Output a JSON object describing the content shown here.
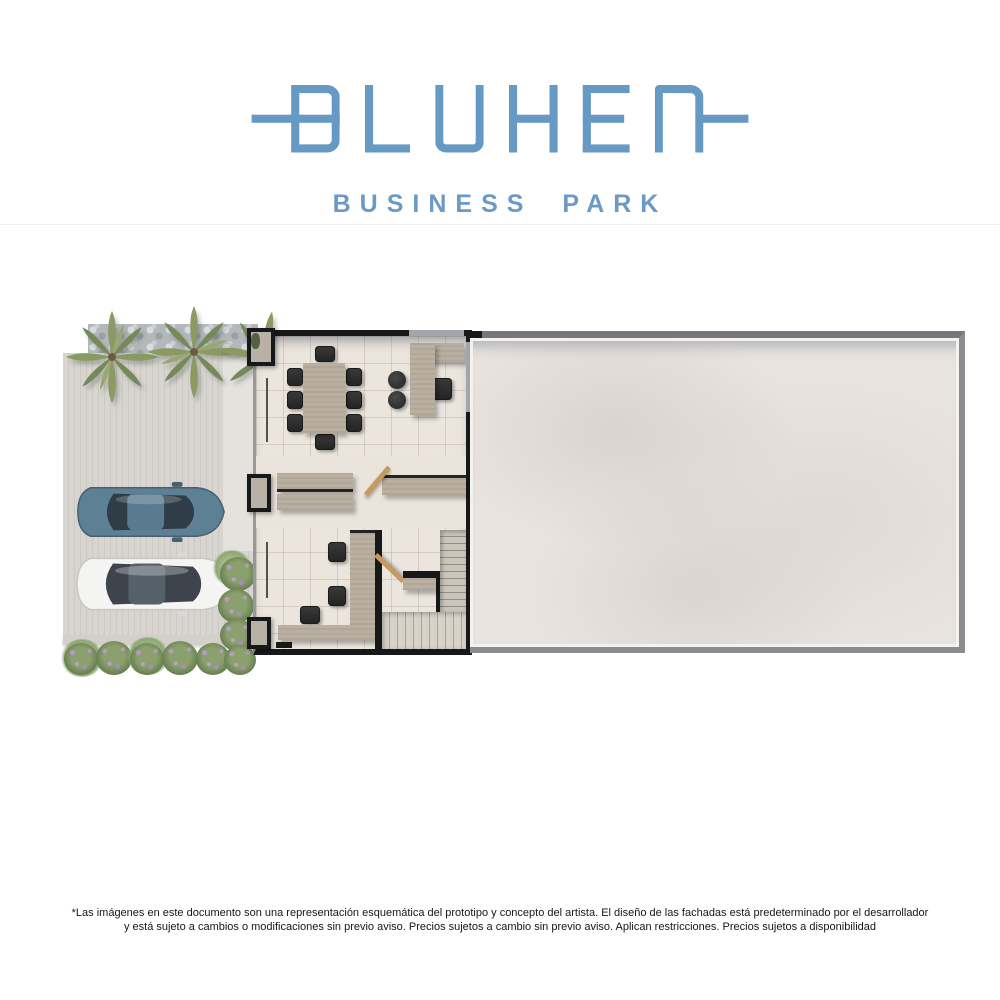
{
  "brand": {
    "wordmark": "BLUHEN",
    "tagline": "BUSINESS PARK",
    "color": "#6699c4"
  },
  "disclaimer": {
    "line1": "*Las imágenes en este documento son una representación esquemática del prototipo y concepto del artista. El diseño de las  fachadas está predeterminado por el desarrollador",
    "line2": "y está sujeto a cambios o modificaciones sin previo aviso. Precios sujetos a cambio sin previo aviso. Aplican restricciones. Precios sujetos a disponibilidad"
  },
  "floor_plan": {
    "areas": [
      "parking-lot",
      "office-interior",
      "open-patio"
    ],
    "furniture": [
      "conference-table-8-chairs",
      "reception-l-desk",
      "two-poufs",
      "double-counter",
      "side-counter",
      "l-shaped-office-desk-3-chairs",
      "staircase",
      "two-doors"
    ],
    "vehicles": [
      "blue-sedan",
      "white-sedan"
    ],
    "landscaping": [
      "3-palm-trees",
      "gravel-strip",
      "flower-shrubs"
    ],
    "palette": {
      "wall": "#17181a",
      "wood": "#b9b0a1",
      "floor_tile": "#ebe5dd",
      "patio_floor": "#e9e4e0",
      "parking_concrete": "#d6d3ce",
      "car_blue": "#5d8095",
      "car_white": "#f4f4f3",
      "vegetation": "#8ba06c",
      "flower": "#b49bc6"
    }
  }
}
